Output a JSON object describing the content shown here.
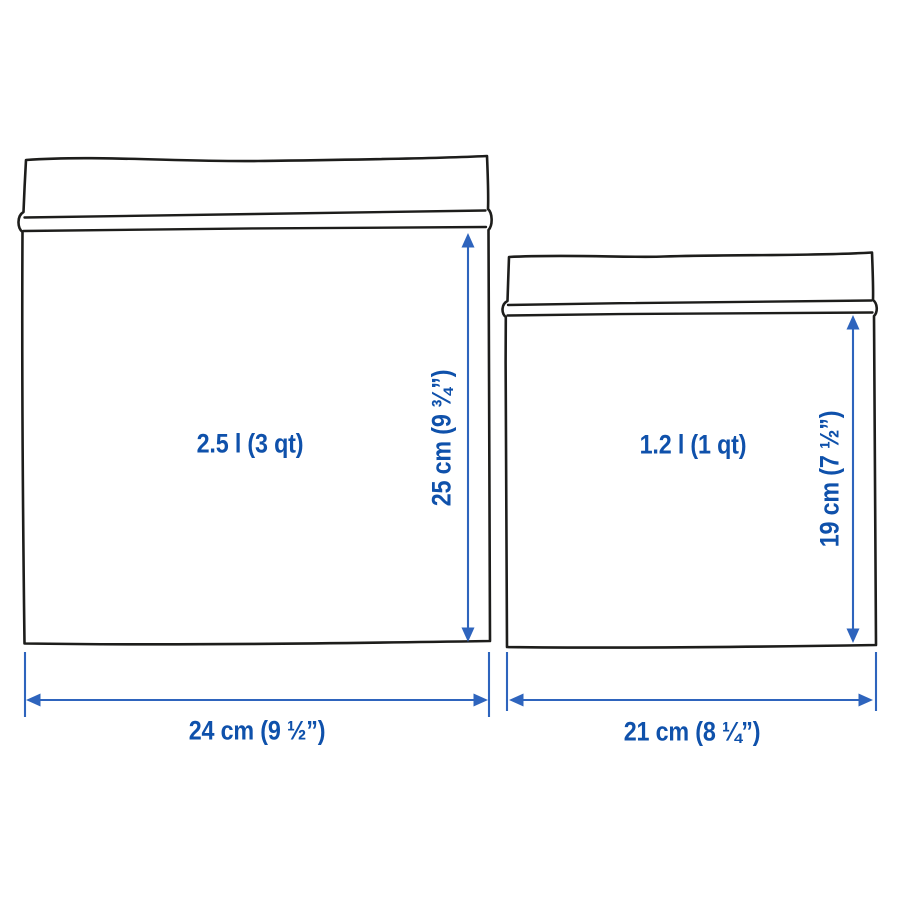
{
  "bags": [
    {
      "id": "large-bag",
      "volume_label": "2.5 l (3 qt)",
      "height_label": "25 cm (9 ¾”)",
      "width_label": "24 cm (9 ½”)"
    },
    {
      "id": "small-bag",
      "volume_label": "1.2 l (1 qt)",
      "height_label": "19 cm (7 ½”)",
      "width_label": "21 cm (8 ¼”)"
    }
  ],
  "colors": {
    "label_blue": "#0f51ab",
    "arrow_blue": "#2e64bd",
    "outline_black": "#1d1d1b",
    "background": "#ffffff"
  }
}
